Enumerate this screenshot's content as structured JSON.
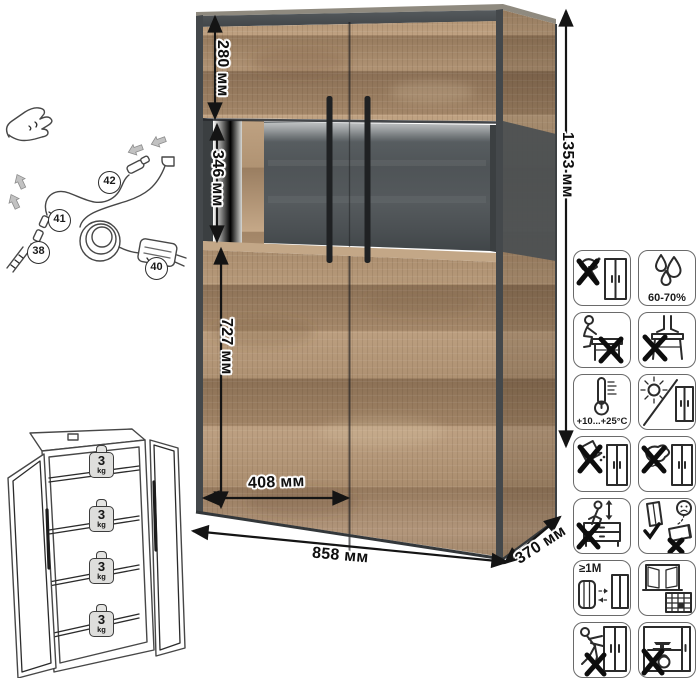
{
  "canvas": {
    "width": 700,
    "height": 678,
    "background": "#ffffff"
  },
  "dimension_labels": {
    "top_section_height": "280 мм",
    "glass_section_height": "346 мм",
    "bottom_section_height": "727 мм",
    "door_width": "408 мм",
    "total_width": "858 мм",
    "depth": "370 мм",
    "total_height": "1353 мм"
  },
  "power_kit": {
    "part_38": "38",
    "part_40": "40",
    "part_41": "41",
    "part_42": "42"
  },
  "load_limits": {
    "shelves": [
      {
        "value": "3",
        "unit": "kg"
      },
      {
        "value": "3",
        "unit": "kg"
      },
      {
        "value": "3",
        "unit": "kg"
      },
      {
        "value": "3",
        "unit": "kg"
      }
    ]
  },
  "care_icons": {
    "humidity_label": "60-70%",
    "temperature_label": "+10...+25°C",
    "distance_label": "≥1M",
    "cells": [
      {
        "name": "no-sharp-tools-icon"
      },
      {
        "name": "humidity-range-icon",
        "label": "60-70%"
      },
      {
        "name": "no-sitting-icon"
      },
      {
        "name": "no-standing-icon"
      },
      {
        "name": "temperature-range-icon",
        "label": "+10...+25°C"
      },
      {
        "name": "no-direct-sunlight-icon"
      },
      {
        "name": "no-spilling-liquids-icon"
      },
      {
        "name": "no-wet-cleaning-icon"
      },
      {
        "name": "no-jumping-icon"
      },
      {
        "name": "carry-upright-icon"
      },
      {
        "name": "heat-source-distance-icon",
        "label": "≥1M"
      },
      {
        "name": "ventilate-room-icon"
      },
      {
        "name": "no-dragging-icon"
      },
      {
        "name": "no-heavy-items-icon"
      }
    ]
  },
  "colors": {
    "wood_light": "#c0a383",
    "wood_mid": "#a98c6c",
    "wood_dark": "#8a6f55",
    "carcass_slate": "#44484b",
    "glass_back": "#4f5457",
    "handle": "#1f2123",
    "dimension_text": "#0f0f0f",
    "icon_border": "#6a6a6a"
  }
}
